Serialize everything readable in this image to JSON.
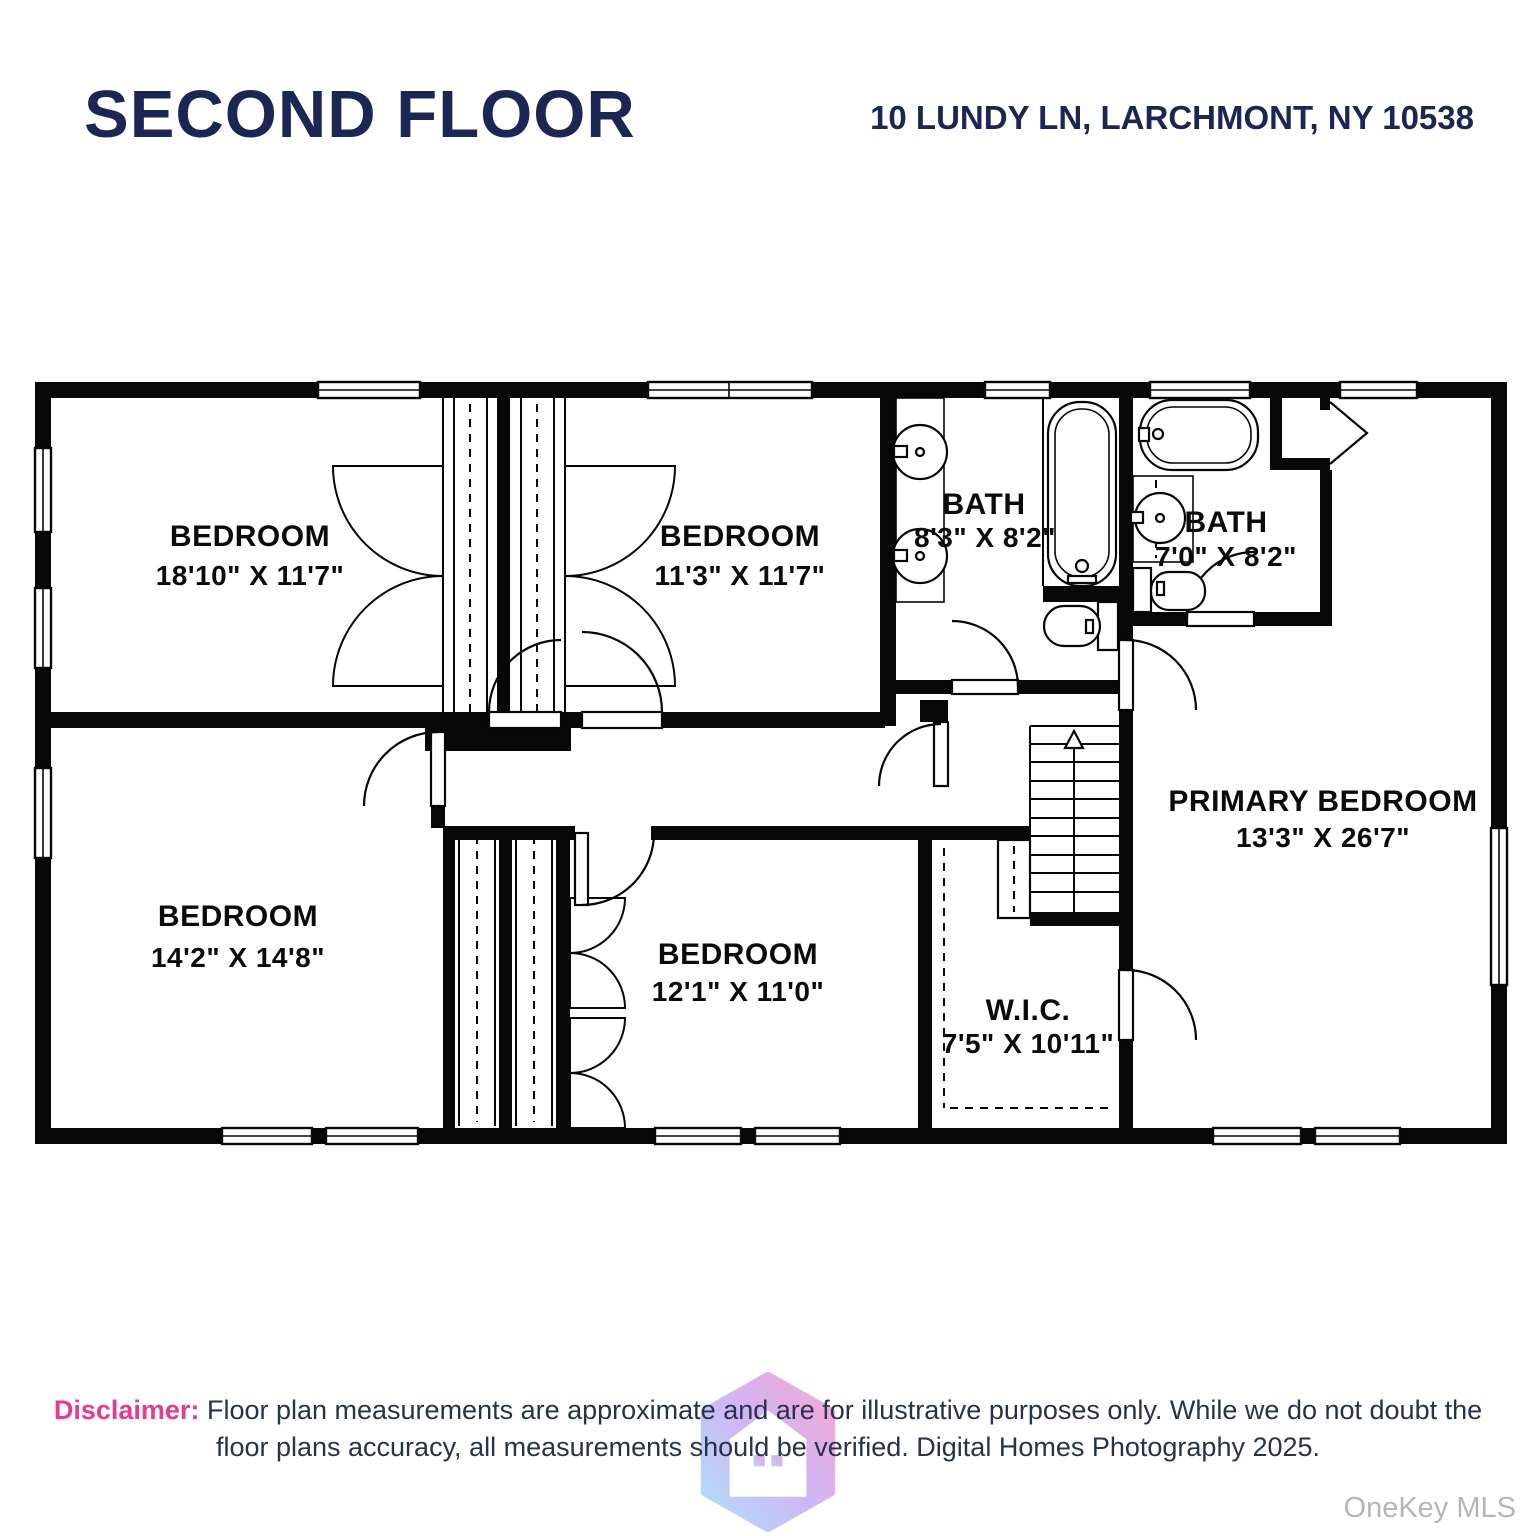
{
  "header": {
    "title": "SECOND FLOOR",
    "address": "10 LUNDY LN, LARCHMONT, NY 10538"
  },
  "rooms": {
    "bedroom1": {
      "name": "BEDROOM",
      "dims": "18'10\" X 11'7\""
    },
    "bedroom2": {
      "name": "BEDROOM",
      "dims": "11'3\" X 11'7\""
    },
    "bath1": {
      "name": "BATH",
      "dims": "8'3\" X 8'2\""
    },
    "bath2": {
      "name": "BATH",
      "dims": "7'0\" X 8'2\""
    },
    "primary": {
      "name": "PRIMARY BEDROOM",
      "dims": "13'3\" X 26'7\""
    },
    "bedroom3": {
      "name": "BEDROOM",
      "dims": "14'2\" X 14'8\""
    },
    "bedroom4": {
      "name": "BEDROOM",
      "dims": "12'1\" X 11'0\""
    },
    "wic": {
      "name": "W.I.C.",
      "dims": "7'5\" X 10'11\""
    }
  },
  "disclaimer": {
    "label": "Disclaimer:",
    "line1": "Floor plan measurements are approximate and are for illustrative purposes only. While we do not doubt the",
    "line2": "floor plans accuracy, all measurements should be verified. Digital Homes Photography 2025."
  },
  "watermark": "OneKey MLS",
  "colors": {
    "title_navy": "#1c2654",
    "disclaimer_pink": "#e73a92",
    "wall_black": "#070707",
    "watermark_gray": "#b6b6b6"
  }
}
